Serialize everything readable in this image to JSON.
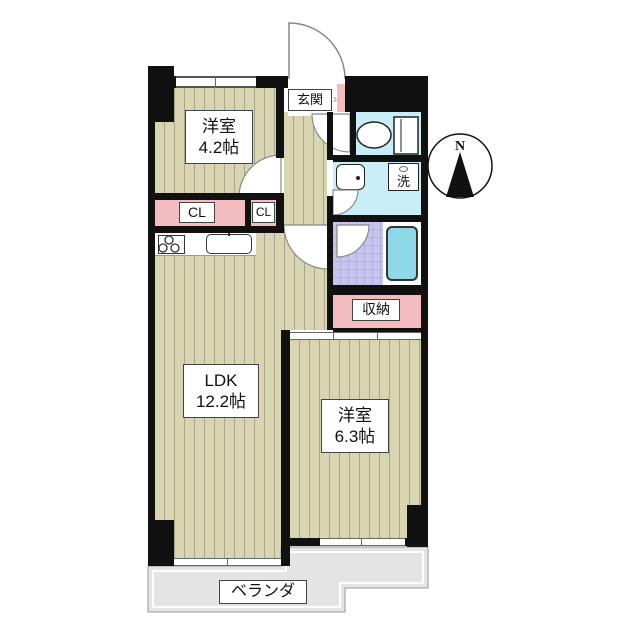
{
  "colors": {
    "wall": "#111111",
    "floor": "#d9d5b2",
    "floor_stripe": "#a9a58a",
    "closet_pink": "#f3bcbe",
    "wet_area_cyan": "#c9eef8",
    "bath_tile_purple": "#c7c5ee",
    "bathtub_cyan": "#8ed8e8",
    "veranda_gray": "#e4e4e4"
  },
  "rooms": {
    "western1": {
      "name": "洋室",
      "size": "4.2帖"
    },
    "ldk": {
      "name": "LDK",
      "size": "12.2帖"
    },
    "western2": {
      "name": "洋室",
      "size": "6.3帖"
    }
  },
  "labels": {
    "entrance": "玄関",
    "entrance_arrow": "›",
    "closet1": "CL",
    "closet2": "CL",
    "laundry": "洗",
    "storage": "収納",
    "veranda": "ベランダ",
    "compass_north": "N"
  }
}
